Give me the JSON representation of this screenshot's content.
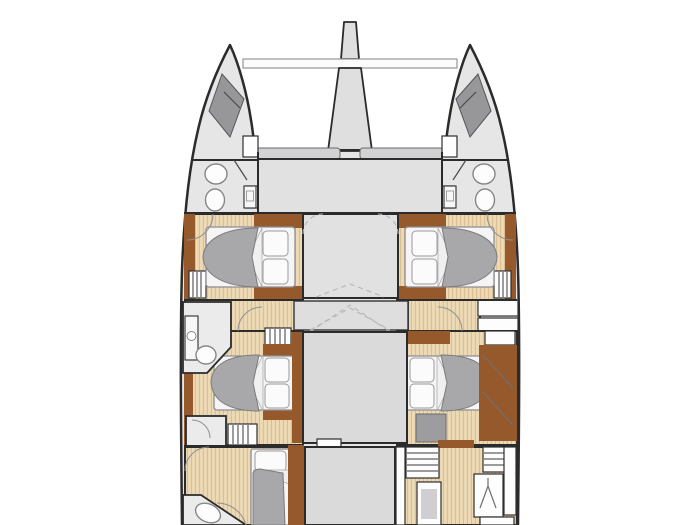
{
  "meta": {
    "title": "Catamaran interior deck layout plan",
    "view": "top-down floor plan",
    "background": "#ffffff"
  },
  "colors": {
    "hull_fill": "#e6e6e7",
    "outline": "#2b2b2b",
    "spar_fill": "#dfdfe0",
    "beam_fill": "#fbfbfb",
    "deck_gray": "#e1e1e2",
    "center_gray": "#dadadb",
    "corridor_gray": "#dededf",
    "head_gray": "#ebebec",
    "forepeak_gray": "#97979a",
    "wood_light": "#edd9b3",
    "wood_grain": "#d8bd90",
    "wood_dark": "#96592c",
    "bed_duvet": "#a8a8aa",
    "bed_linen": "#f5f5f5",
    "dash_gray": "#b5b5b5"
  },
  "plan": {
    "vessel": "sailing-catamaran",
    "symmetry": "port-starboard",
    "elements": [
      "bowsprit",
      "forward-crossbeam",
      "trampoline",
      "port-bow-locker",
      "starboard-bow-locker",
      "foredeck-lounge",
      "port-forward-head",
      "starboard-forward-head",
      "port-forward-cabin-double-berth",
      "starboard-forward-cabin-double-berth",
      "forward-bridgedeck",
      "athwartship-corridor",
      "port-midship-head",
      "port-midship-cabin-double-berth",
      "starboard-midship-cabin-double-berth",
      "starboard-wardrobe",
      "saloon-bridgedeck",
      "port-aft-cabin-single-berth",
      "port-aft-head",
      "starboard-storage-units",
      "starboard-hanging-locker",
      "aft-bridgedeck"
    ],
    "berths_depicted": 5,
    "toilets_depicted": 4
  }
}
